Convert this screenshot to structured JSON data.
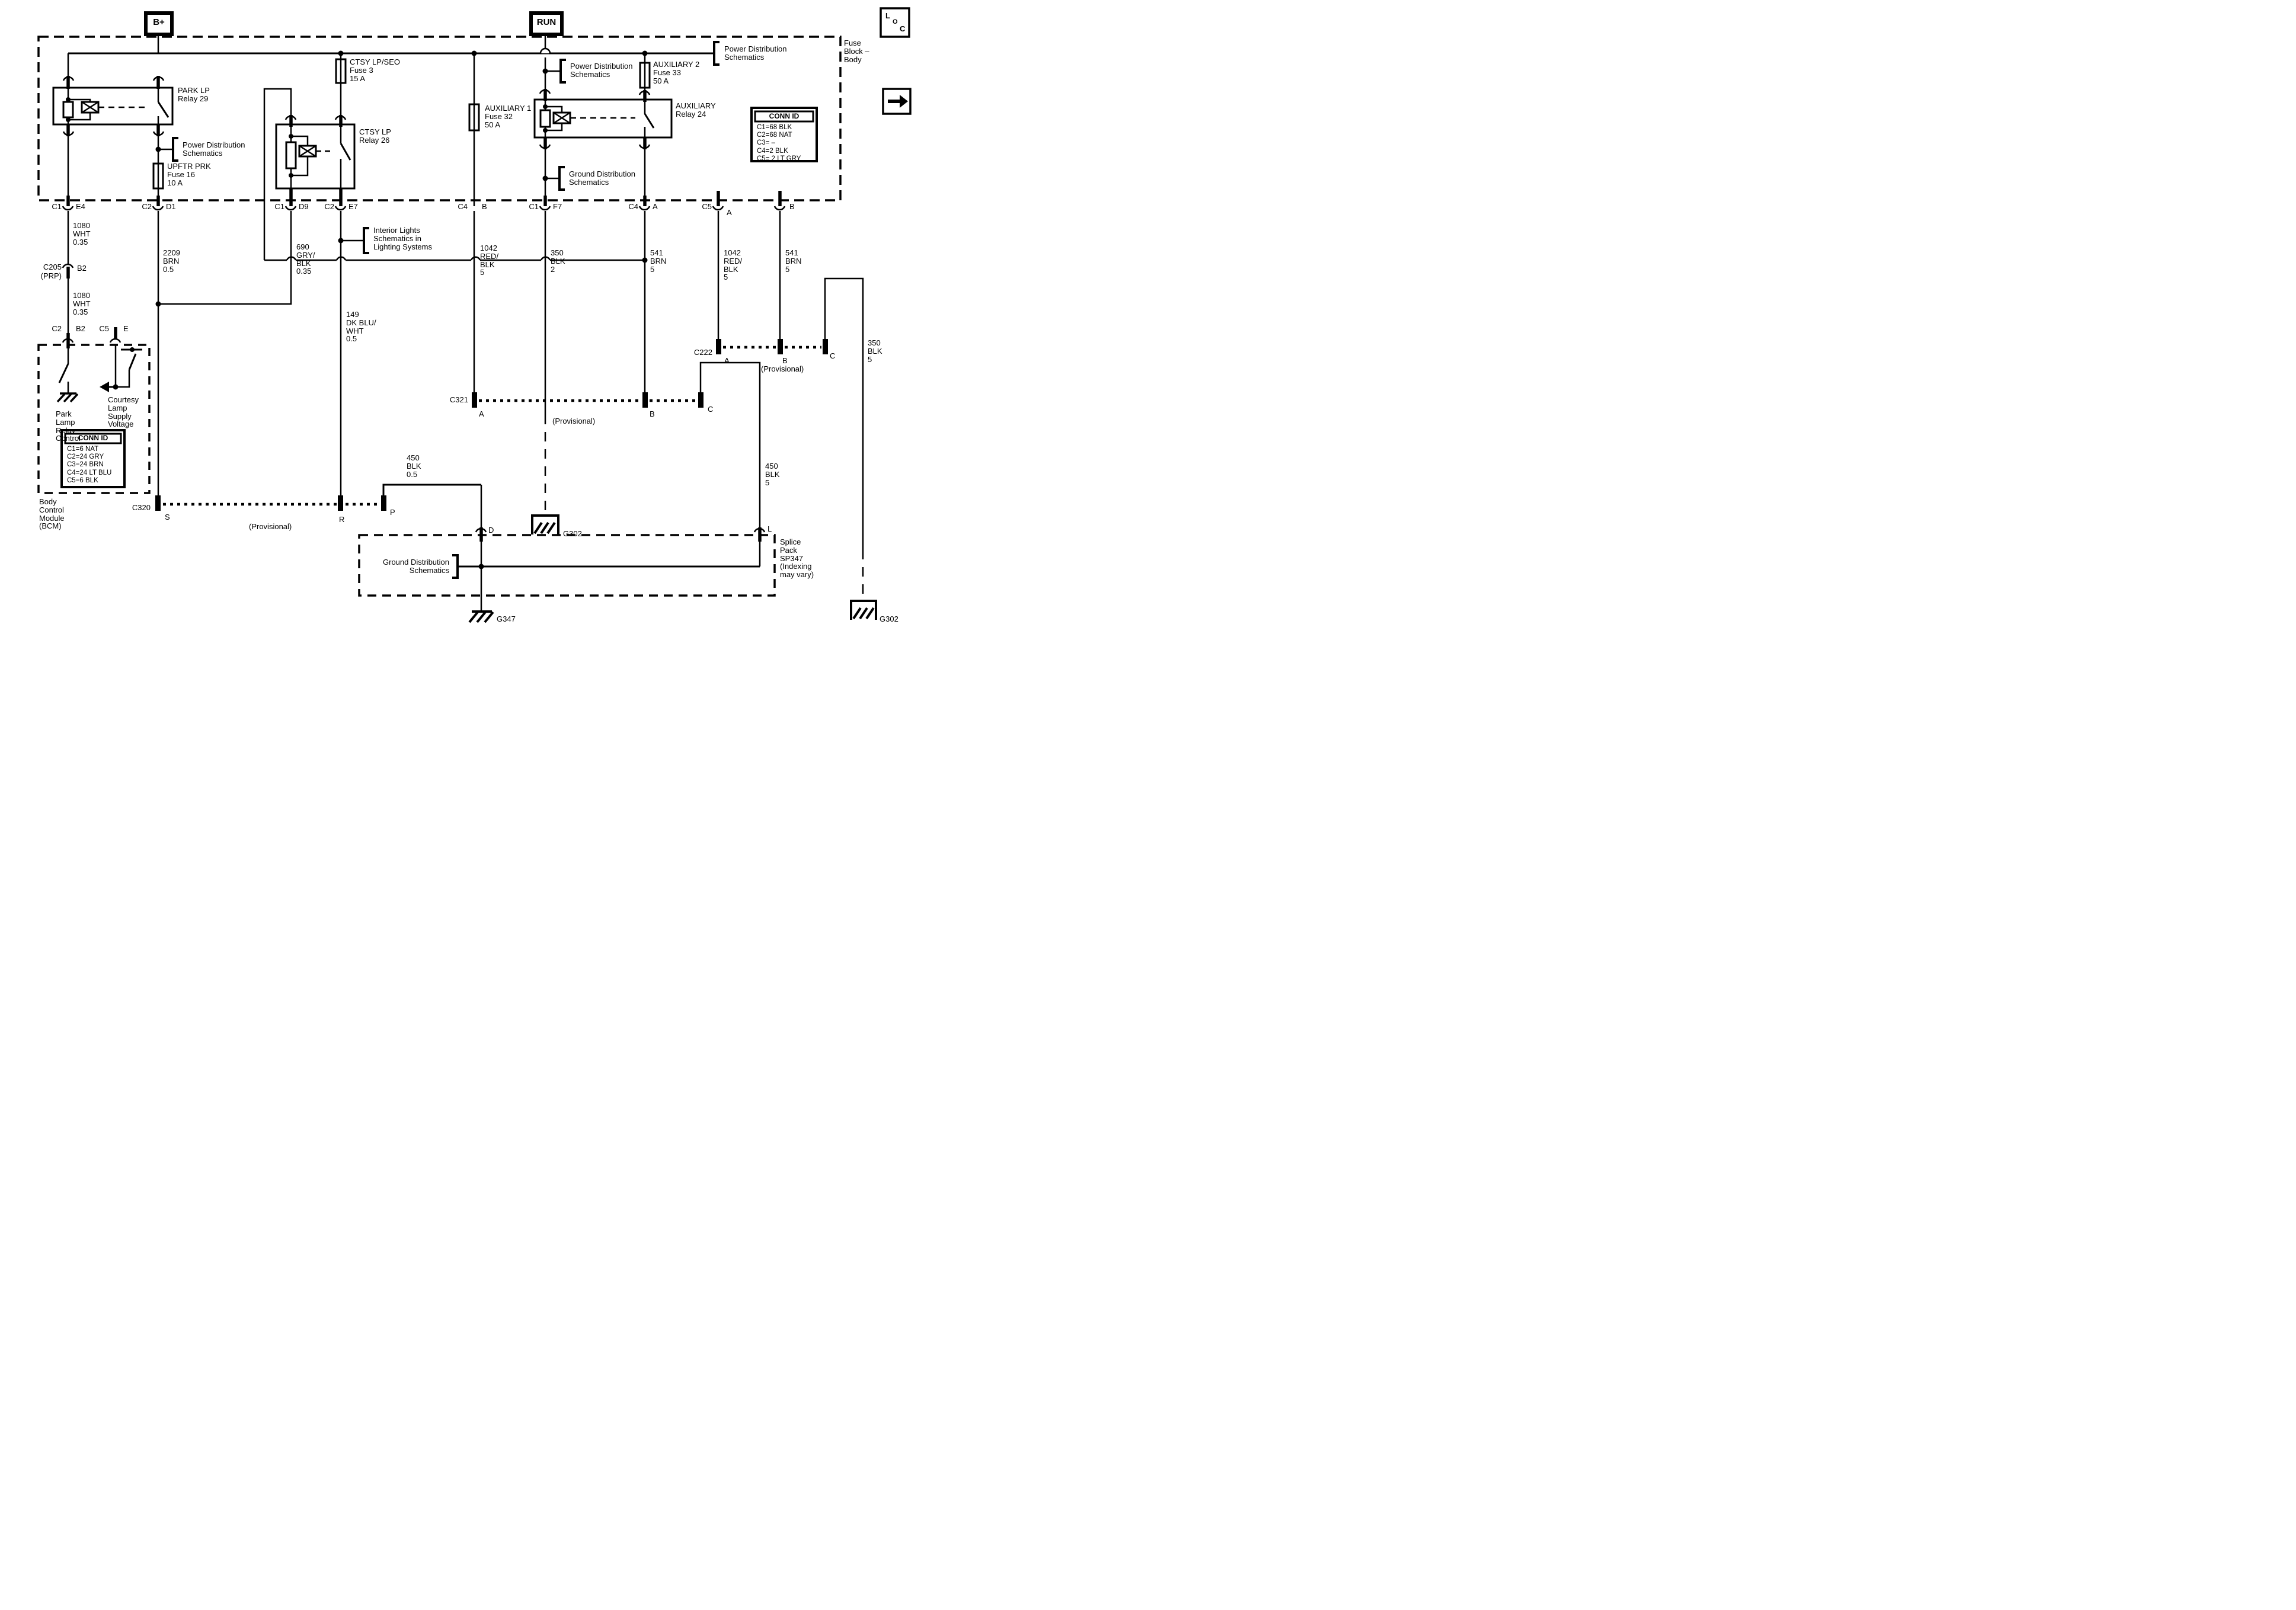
{
  "power": {
    "bplus": "B+",
    "run": "RUN"
  },
  "fuse_block_label": [
    "Fuse",
    "Block –",
    "Body"
  ],
  "loc_icon": {
    "l": "L",
    "o": "O",
    "c": "C"
  },
  "relays": {
    "park": [
      "PARK LP",
      "Relay 29"
    ],
    "ctsy": [
      "CTSY LP",
      "Relay 26"
    ],
    "aux": [
      "AUXILIARY",
      "Relay 24"
    ]
  },
  "fuses": {
    "f3": [
      "CTSY LP/SEO",
      "Fuse 3",
      "15 A"
    ],
    "f16": [
      "UPFTR PRK",
      "Fuse 16",
      "10 A"
    ],
    "f32": [
      "AUXILIARY 1",
      "Fuse 32",
      "50 A"
    ],
    "f33": [
      "AUXILIARY 2",
      "Fuse 33",
      "50 A"
    ]
  },
  "callouts": {
    "pds1": [
      "Power Distribution",
      "Schematics"
    ],
    "pds2": [
      "Power Distribution",
      "Schematics"
    ],
    "pds3": [
      "Power Distribution",
      "Schematics"
    ],
    "interior": [
      "Interior Lights",
      "Schematics in",
      "Lighting Systems"
    ],
    "gds1": [
      "Ground Distribution",
      "Schematics"
    ],
    "gds2": [
      "Ground Distribution",
      "Schematics"
    ]
  },
  "conn_id_block": {
    "title": "CONN ID",
    "rows": [
      "C1=68 BLK",
      "C2=68 NAT",
      "C3= –",
      "C4=2 BLK",
      "C5= 2 LT GRY"
    ]
  },
  "conn_id_bcm": {
    "title": "CONN ID",
    "rows": [
      "C1=6 NAT",
      "C2=24 GRY",
      "C3=24 BRN",
      "C4=24 LT BLU",
      "C5=6 BLK"
    ]
  },
  "bcm": {
    "label": [
      "Body",
      "Control",
      "Module",
      "(BCM)"
    ],
    "park_lamp": [
      "Park",
      "Lamp",
      "Relay",
      "Control"
    ],
    "courtesy": [
      "Courtesy",
      "Lamp",
      "Supply",
      "Voltage"
    ]
  },
  "wires": {
    "w1080a": [
      "1080",
      "WHT",
      "0.35"
    ],
    "w1080b": [
      "1080",
      "WHT",
      "0.35"
    ],
    "w2209": [
      "2209",
      "BRN",
      "0.5"
    ],
    "w690": [
      "690",
      "GRY/",
      "BLK",
      "0.35"
    ],
    "w149": [
      "149",
      "DK BLU/",
      "WHT",
      "0.5"
    ],
    "w1042a": [
      "1042",
      "RED/",
      "BLK",
      "5"
    ],
    "w350a": [
      "350",
      "BLK",
      "2"
    ],
    "w541a": [
      "541",
      "BRN",
      "5"
    ],
    "w1042b": [
      "1042",
      "RED/",
      "BLK",
      "5"
    ],
    "w541b": [
      "541",
      "BRN",
      "5"
    ],
    "w450a": [
      "450",
      "BLK",
      "0.5"
    ],
    "w450b": [
      "450",
      "BLK",
      "5"
    ],
    "w350b": [
      "350",
      "BLK",
      "5"
    ]
  },
  "pins": {
    "p1": {
      "c": "C1",
      "t": "E4"
    },
    "p2": {
      "c": "C2",
      "t": "D1"
    },
    "p3": {
      "c": "C1",
      "t": "D9"
    },
    "p4": {
      "c": "C2",
      "t": "E7"
    },
    "p5": {
      "c": "C4",
      "t": "B"
    },
    "p6": {
      "c": "C1",
      "t": "F7"
    },
    "p7": {
      "c": "C4",
      "t": "A"
    },
    "p8": {
      "c": "C5",
      "t": "A"
    },
    "p9": {
      "t": "B"
    },
    "bcm1": {
      "c": "C2",
      "t": "B2"
    },
    "bcm2": {
      "c": "C5",
      "t": "E"
    }
  },
  "connectors": {
    "c205": {
      "name": "C205",
      "sub": "(PRP)",
      "pin": "B2"
    },
    "c320": {
      "name": "C320",
      "a": "S",
      "b": "R",
      "cpin": "P",
      "note": "(Provisional)"
    },
    "c321": {
      "name": "C321",
      "a": "A",
      "b": "B",
      "cpin": "C",
      "note": "(Provisional)"
    },
    "c222": {
      "name": "C222",
      "a": "A",
      "b": "B",
      "cpin": "C",
      "note": "(Provisional)"
    }
  },
  "grounds": {
    "g302a": "G302",
    "g347": "G347",
    "g302b": "G302"
  },
  "splice": {
    "label": [
      "Splice",
      "Pack",
      "SP347",
      "(Indexing",
      "may vary)"
    ]
  }
}
